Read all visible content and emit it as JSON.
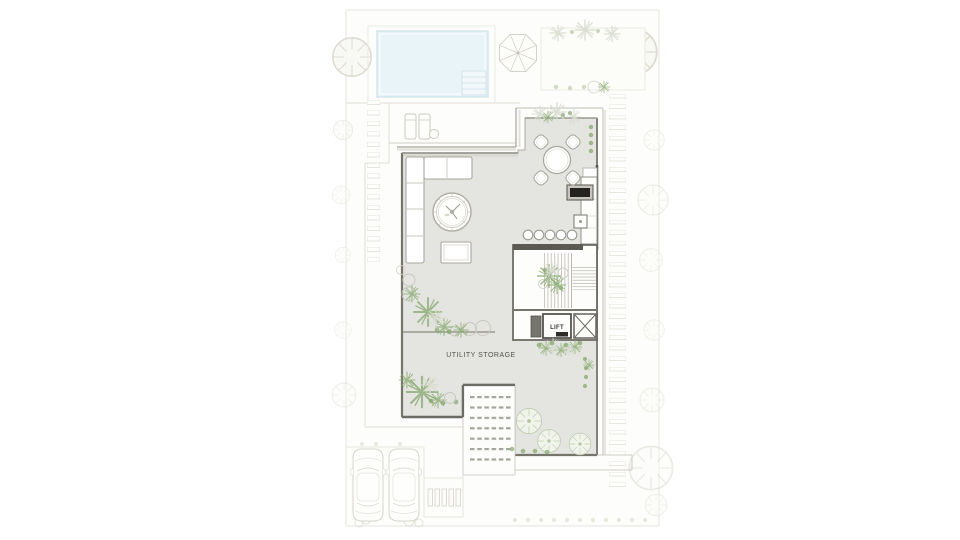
{
  "plan": {
    "type": "architectural-floor-plan",
    "view": "villa-ground-floor-site-plan"
  },
  "labels": {
    "utility_storage": "UTILITY STORAGE",
    "lift": "LIFT"
  },
  "colors": {
    "canvas": "#ffffff",
    "plot_fill": "#fdfdfb",
    "plot_border": "#e6e4dd",
    "pool_water": "#e9f4f9",
    "pool_edge": "#c9dfe9",
    "floor_gray": "#e4e4e0",
    "wall_dark": "#5a5952",
    "wall_mid": "#8a8981",
    "line_light": "#c6c4bc",
    "line_faint": "#e6e4dc",
    "plant_green": "#85a86c",
    "plant_soft": "#c2cdb4",
    "label_text": "#53524c"
  },
  "counts": {
    "bar_stools": 5,
    "dining_chairs": 4,
    "cars": 2,
    "sun_loungers": 2
  },
  "elements": [
    {
      "name": "swimming-pool"
    },
    {
      "name": "pool-steps"
    },
    {
      "name": "parasol"
    },
    {
      "name": "sun-loungers",
      "count": 2
    },
    {
      "name": "poolside-table"
    },
    {
      "name": "ne-garden-terrace"
    },
    {
      "name": "stepping-stone-paths",
      "count": 2
    },
    {
      "name": "l-shaped-sofa"
    },
    {
      "name": "round-rug-coffee-table"
    },
    {
      "name": "ottoman"
    },
    {
      "name": "dining-table",
      "chairs": 4
    },
    {
      "name": "kitchen-counter"
    },
    {
      "name": "cooktop"
    },
    {
      "name": "sink"
    },
    {
      "name": "bar-stools",
      "count": 5
    },
    {
      "name": "staircase"
    },
    {
      "name": "stair-plant"
    },
    {
      "name": "lift"
    },
    {
      "name": "service-shaft"
    },
    {
      "name": "entry-ramp"
    },
    {
      "name": "parked-cars",
      "count": 2
    },
    {
      "name": "driveway-grille"
    },
    {
      "name": "garden-trees"
    },
    {
      "name": "planting-beds"
    }
  ]
}
